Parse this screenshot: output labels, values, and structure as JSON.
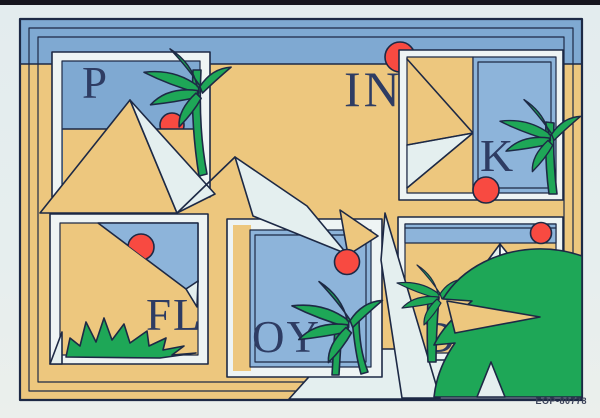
{
  "artwork": {
    "description": "Postcard illustration: hidden word spelled across framed desert scenes",
    "hidden_word": "PINK FLOYD",
    "letters": {
      "p": "P",
      "in": "IN",
      "k": "K",
      "fl": "FL",
      "oy": "OY",
      "d": "D"
    },
    "catalog_code": "EOP-80778",
    "colors": {
      "page_background": "#e5edee",
      "film_edge": "#15151e",
      "sand": "#edc77e",
      "sky": "#7fa9d2",
      "sky_light": "#8db4da",
      "pale": "#e4efef",
      "white_face": "#f6fbfa",
      "green": "#1ea757",
      "sun_red": "#f84a41",
      "outline": "#1d2945",
      "letter_color": "#2e3c63"
    },
    "elements": [
      "pyramids",
      "palm-trees",
      "suns",
      "desert-bush",
      "nested-frames"
    ]
  }
}
